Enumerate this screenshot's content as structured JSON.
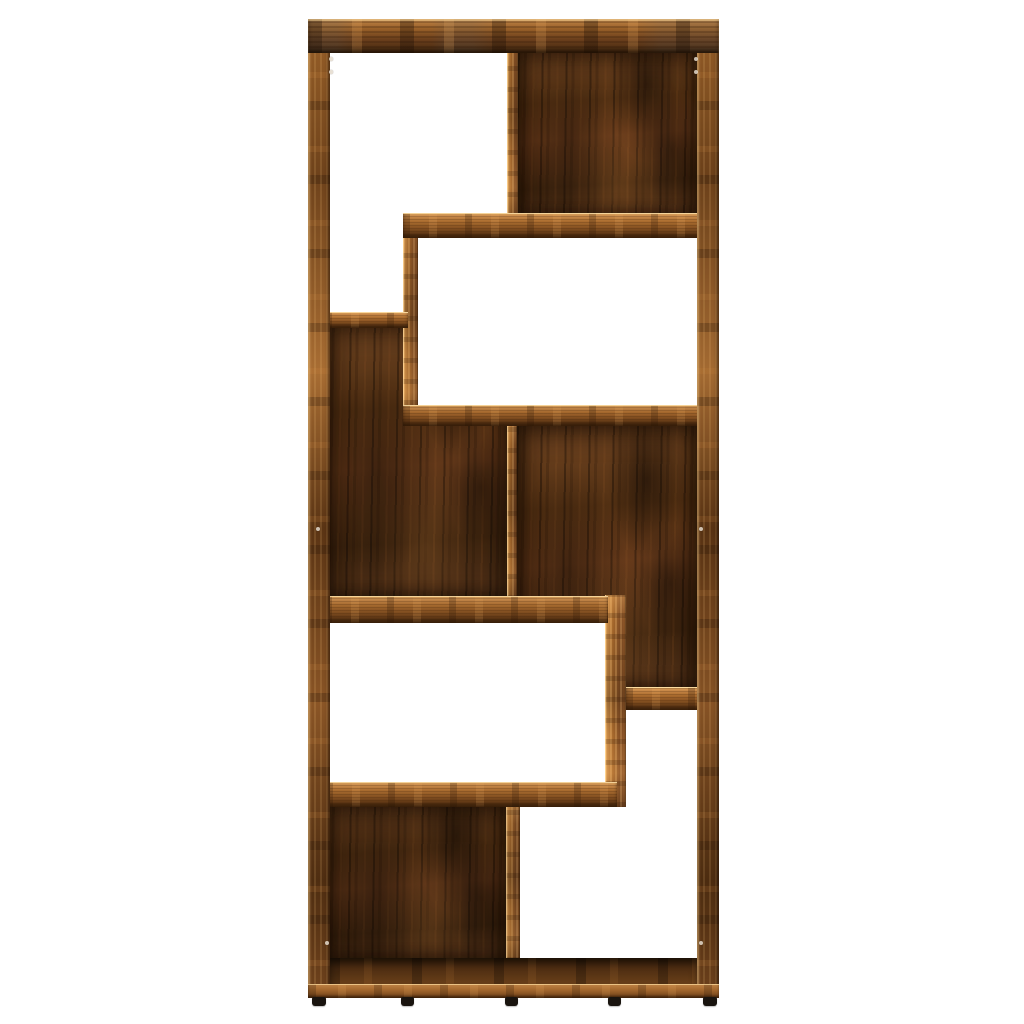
{
  "scene": {
    "type": "product-photo",
    "subject": "geometric-bookcase-smoked-oak",
    "background_color": "#ffffff",
    "wood_palette": {
      "edge_highlight": "#d8a35f",
      "edge_light": "#c08447",
      "edge_mid": "#8f5a28",
      "edge_dark": "#6e421b",
      "back_panel_light": "#714522",
      "back_panel_mid": "#543113",
      "back_panel_dark": "#33200c",
      "smoke_streak_tint": "#50646e",
      "foot_color": "#19140f"
    },
    "structure": {
      "compartment_count": 8,
      "back_panel_count": 4,
      "open_compartment_count": 4,
      "shelf_count": 6,
      "divider_count": 4,
      "feet_count": 5
    }
  }
}
